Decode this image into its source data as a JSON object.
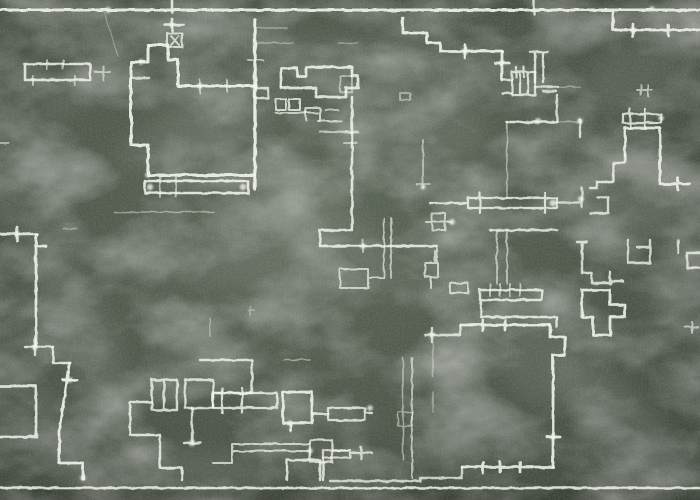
{
  "scene": {
    "subject": "hand-drawn chalk floor plan on a green chalkboard",
    "width": 700,
    "height": 500,
    "board": {
      "base_color_center": "#5a6455",
      "base_color_mid": "#4e574a",
      "base_color_edge": "#3f473c",
      "top_strip_color": "#3a4136",
      "bottom_strip_color": "#30362c"
    },
    "frame": {
      "color": "#e9eee3",
      "lines": [
        {
          "y": 10,
          "w": 3.0,
          "o": 0.95
        },
        {
          "y": 488,
          "w": 2.4,
          "o": 0.9
        }
      ]
    }
  },
  "drawing": {
    "chalk_color": "#f2f5ee",
    "strokes": [
      {
        "d": "M25,64 H90 V80 H25 Z",
        "w": 2.6,
        "o": 0.85
      },
      {
        "d": "M47,60 V69 M63,60 V69 M33,76 V85 M75,76 V85",
        "w": 2,
        "o": 0.6
      },
      {
        "d": "M95,72 H110 M103,66 V80",
        "w": 2,
        "o": 0.6
      },
      {
        "d": "M172,0 V12 M165,25 H184 M172,19 V31",
        "w": 2.6,
        "o": 0.85
      },
      {
        "d": "M167,33 H182 V47 H167 Z M171,36 L179,45 M179,36 L171,45",
        "w": 2,
        "o": 0.75
      },
      {
        "d": "M0,143 H9",
        "w": 2,
        "o": 0.5
      },
      {
        "d": "M104,12 L118,56",
        "w": 1.2,
        "o": 0.3
      },
      {
        "d": "M148,45 H168 V60 H178 V86 H255",
        "w": 3,
        "o": 0.9
      },
      {
        "d": "M148,45 V62 H131 V145 H148 V175 H255",
        "w": 3,
        "o": 0.9
      },
      {
        "d": "M131,78 H149",
        "w": 2.4,
        "o": 0.75
      },
      {
        "d": "M255,20 V189",
        "w": 3.4,
        "o": 0.92
      },
      {
        "d": "M200,80 V93 M227,80 V91 M248,60 H263",
        "w": 2,
        "o": 0.6
      },
      {
        "d": "M258,28 H287 M256,43 H293 M338,43 H358",
        "w": 1.4,
        "o": 0.38
      },
      {
        "d": "M145,181 H248 V193 H145 Z",
        "w": 2.6,
        "o": 0.88
      },
      {
        "d": "M160,177 V197 M176,177 V197",
        "w": 2,
        "o": 0.55
      },
      {
        "d": "M114,212 H214",
        "w": 1.6,
        "o": 0.45
      },
      {
        "d": "M64,229 H78",
        "w": 1.5,
        "o": 0.4
      },
      {
        "d": "M0,234 H37 M17,227 V241",
        "w": 2.6,
        "o": 0.85
      },
      {
        "d": "M36,234 V347 M38,246 H46",
        "w": 2.8,
        "o": 0.88
      },
      {
        "d": "M25,347 H53 M35,340 V355",
        "w": 2.4,
        "o": 0.8
      },
      {
        "d": "M53,347 V363 H70",
        "w": 2.4,
        "o": 0.85
      },
      {
        "d": "M70,363 L59,430 V463 H83 V479 M63,380 H77",
        "w": 2.8,
        "o": 0.9
      },
      {
        "d": "M0,386 H36 V437 H0",
        "w": 2.8,
        "o": 0.85
      },
      {
        "d": "M281,87 V68 H297 V76 H306 V67 H352 V76",
        "w": 2.8,
        "o": 0.88
      },
      {
        "d": "M352,76 H358 V88 H346 V97 H316 V88 H281",
        "w": 2.8,
        "o": 0.85
      },
      {
        "d": "M255,88 H268 V98 H255",
        "w": 2.4,
        "o": 0.8
      },
      {
        "d": "M276,99 H286 V110 H276 Z M289,99 H300 V110 H289 Z",
        "w": 2,
        "o": 0.78
      },
      {
        "d": "M276,113 H318 M318,121 H341",
        "w": 2,
        "o": 0.7
      },
      {
        "d": "M306,120 V108 H320 V121",
        "w": 2,
        "o": 0.72
      },
      {
        "d": "M320,132 H358 M325,110 H338",
        "w": 2,
        "o": 0.6
      },
      {
        "d": "M352,97 V230 H320 V246 H437",
        "w": 2.6,
        "o": 0.85
      },
      {
        "d": "M345,133 H359 M344,143 H357 M363,240 V252",
        "w": 2,
        "o": 0.55
      },
      {
        "d": "M437,246 V263 M425,263 H438 V277 H425 Z M435,251 V263 M431,277 V288",
        "w": 2,
        "o": 0.7
      },
      {
        "d": "M423,140 V188 M416,184 H430",
        "w": 1.8,
        "o": 0.55
      },
      {
        "d": "M384,218 V278 M391,218 V278",
        "w": 1.8,
        "o": 0.65
      },
      {
        "d": "M340,269 H368 V288 H340 Z M368,278 H384",
        "w": 2,
        "o": 0.7
      },
      {
        "d": "M450,283 H468 V293 H450 Z",
        "w": 2,
        "o": 0.7
      },
      {
        "d": "M403,18 V33 H427 V43 H440 V51 H502 M465,45 V58",
        "w": 2.8,
        "o": 0.9
      },
      {
        "d": "M502,51 V80 M495,63 H509",
        "w": 2.8,
        "o": 0.88
      },
      {
        "d": "M512,72 H535 V95 H512 Z M520,72 V95 M528,72 V95 M516,67 V77 M524,67 V77",
        "w": 2.2,
        "o": 0.8
      },
      {
        "d": "M502,80 H512 M502,93 H512",
        "w": 2.4,
        "o": 0.8
      },
      {
        "d": "M535,82 V52 H543 V82 M530,52 H548",
        "w": 2.4,
        "o": 0.82
      },
      {
        "d": "M535,87 H558 M543,91 H556",
        "w": 2.4,
        "o": 0.75
      },
      {
        "d": "M558,87 H580 M557,122 H580",
        "w": 1.5,
        "o": 0.42
      },
      {
        "d": "M557,95 V122 M580,120 V137",
        "w": 2.4,
        "o": 0.78
      },
      {
        "d": "M507,122 H557",
        "w": 2.6,
        "o": 0.85
      },
      {
        "d": "M507,122 V198",
        "w": 1.5,
        "o": 0.5
      },
      {
        "d": "M613,10 V30 H700 M633,24 V37 M668,25 V35",
        "w": 2.8,
        "o": 0.88
      },
      {
        "d": "M534,0 V14",
        "w": 2.4,
        "o": 0.8
      },
      {
        "d": "M637,90 H652 M641,85 V95 M648,85 V96",
        "w": 2,
        "o": 0.6
      },
      {
        "d": "M623,114 H661 V123 H623 Z M630,109 V128 M645,109 V128",
        "w": 2.2,
        "o": 0.8
      },
      {
        "d": "M625,155 V128 H660 V184 H690 M678,178 V190",
        "w": 2.8,
        "o": 0.88
      },
      {
        "d": "M625,155 V163 H613 V182 H597 V188 H590",
        "w": 2.4,
        "o": 0.82
      },
      {
        "d": "M597,197 H608 V213 H590",
        "w": 2.4,
        "o": 0.78
      },
      {
        "d": "M582,188 V207 M557,203 H581",
        "w": 2.6,
        "o": 0.7
      },
      {
        "d": "M582,242 V273 H592 V283 H611 M577,242 H587 M610,272 V284 M611,281 H623",
        "w": 2.4,
        "o": 0.8
      },
      {
        "d": "M628,240 V263 H650 V247 H637 M650,240 V247",
        "w": 2.4,
        "o": 0.78
      },
      {
        "d": "M678,240 V253 M687,253 H700 M687,253 V268 M687,268 H700",
        "w": 2.4,
        "o": 0.78
      },
      {
        "d": "M582,290 H610 V305 H625 V317 H610 V335 H593 V317 H582 Z",
        "w": 2.8,
        "o": 0.88
      },
      {
        "d": "M685,327 H698 M692,322 V333",
        "w": 2,
        "o": 0.6
      },
      {
        "d": "M460,325 H550 M483,320 V331 M505,320 V330",
        "w": 2.8,
        "o": 0.9
      },
      {
        "d": "M460,325 V335 H450 M425,335 H450 M432,328 V342",
        "w": 2.4,
        "o": 0.78
      },
      {
        "d": "M550,325 V337 H565 V355 H553 V467 M547,437 H560",
        "w": 2.8,
        "o": 0.9
      },
      {
        "d": "M462,467 H553 M483,462 V473 M500,462 V472 M520,462 V472",
        "w": 2.8,
        "o": 0.88
      },
      {
        "d": "M462,467 V478 H420 M330,481 H420 V478",
        "w": 2.4,
        "o": 0.75
      },
      {
        "d": "M412,358 V478",
        "w": 2,
        "o": 0.6
      },
      {
        "d": "M403,358 V460 M398,412 H412 V426 H398 Z",
        "w": 1.6,
        "o": 0.5
      },
      {
        "d": "M433,343 V377 M433,392 V412",
        "w": 1.4,
        "o": 0.4
      },
      {
        "d": "M480,290 H542 V300 H480 Z M481,300 V317 M481,317 H542 M542,317 H557 V327",
        "w": 2.4,
        "o": 0.84
      },
      {
        "d": "M490,284 V296 M500,284 V296 M510,284 V296 M520,284 V296",
        "w": 2,
        "o": 0.6
      },
      {
        "d": "M497,230 V284 M507,230 V284",
        "w": 1.8,
        "o": 0.6
      },
      {
        "d": "M490,230 H557",
        "w": 2.4,
        "o": 0.8
      },
      {
        "d": "M468,198 H557 V208 H468 Z M480,193 V213 M545,193 V213 M430,203 H468",
        "w": 2.2,
        "o": 0.82
      },
      {
        "d": "M432,213 H445 V230 H432 Z M426,222 H451",
        "w": 2,
        "o": 0.68
      },
      {
        "d": "M200,360 H252 V393 H213 V408",
        "w": 2.4,
        "o": 0.82
      },
      {
        "d": "M152,380 H177 V410 H152 Z M164,380 V410",
        "w": 2.4,
        "o": 0.8
      },
      {
        "d": "M185,380 H213 V408 H185 Z",
        "w": 2.4,
        "o": 0.8
      },
      {
        "d": "M152,402 H130 V435 H160 V468 H182 V480",
        "w": 2.4,
        "o": 0.84
      },
      {
        "d": "M192,408 V443 M184,443 H201",
        "w": 2.4,
        "o": 0.8
      },
      {
        "d": "M210,318 V336 M248,310 H254 M250,306 V315",
        "w": 1.5,
        "o": 0.4
      },
      {
        "d": "M284,360 H310",
        "w": 1.5,
        "o": 0.45
      },
      {
        "d": "M232,444 H310 M232,451 H310 M232,444 V463 M213,463 H232",
        "w": 2,
        "o": 0.72
      },
      {
        "d": "M310,440 H332 V462 H310 Z M332,450 H350",
        "w": 2.3,
        "o": 0.78
      },
      {
        "d": "M213,393 H277 V408 H213 M222,388 V413 M242,388 V413",
        "w": 2.3,
        "o": 0.82
      },
      {
        "d": "M283,392 H312 V423 H283 Z M291,423 V431",
        "w": 2.8,
        "o": 0.88
      },
      {
        "d": "M312,414 H328",
        "w": 3,
        "o": 0.78
      },
      {
        "d": "M328,408 H365 V420 H328 Z M365,413 H372",
        "w": 2.3,
        "o": 0.8
      },
      {
        "d": "M323,450 H350 V458 H323 Z M350,453 H372 M361,447 V459",
        "w": 2.3,
        "o": 0.76
      },
      {
        "d": "M287,480 V460 H320 V480 M323,458 V480",
        "w": 2.4,
        "o": 0.82
      },
      {
        "d": "M340,76 H352 V92 H340 Z",
        "w": 1.8,
        "o": 0.55
      },
      {
        "d": "M400,93 H410 V100 H400 Z",
        "w": 1.8,
        "o": 0.5
      }
    ],
    "nodes": [
      [
        108,
        10,
        3
      ],
      [
        652,
        9,
        2.6
      ],
      [
        172,
        25,
        2.6
      ],
      [
        465,
        51,
        3.2
      ],
      [
        502,
        63,
        3
      ],
      [
        553,
        203,
        3.4
      ],
      [
        581,
        199,
        3
      ],
      [
        192,
        443,
        3.2
      ],
      [
        70,
        380,
        2.8
      ],
      [
        35,
        347,
        3
      ],
      [
        17,
        234,
        2.8
      ],
      [
        370,
        408,
        2.8
      ],
      [
        432,
        335,
        3
      ],
      [
        553,
        437,
        2.8
      ],
      [
        661,
        118,
        2.8
      ],
      [
        633,
        30,
        2.8
      ],
      [
        150,
        187,
        3.2
      ],
      [
        243,
        187,
        3.2
      ],
      [
        141,
        62,
        2.8
      ],
      [
        200,
        86,
        2.8
      ],
      [
        538,
        121,
        3
      ],
      [
        580,
        121,
        2.8
      ],
      [
        290,
        423,
        2.6
      ],
      [
        452,
        222,
        3
      ],
      [
        310,
        451,
        2.8
      ],
      [
        83,
        478,
        2.8
      ],
      [
        363,
        246,
        2.6
      ],
      [
        423,
        187,
        2.4
      ],
      [
        255,
        87,
        3
      ],
      [
        148,
        175,
        2.8
      ]
    ],
    "smudges": [
      [
        80,
        330,
        90,
        28,
        65,
        0.1
      ],
      [
        60,
        440,
        80,
        24,
        55,
        0.09
      ],
      [
        230,
        260,
        110,
        30,
        8,
        0.08
      ],
      [
        200,
        130,
        90,
        26,
        -20,
        0.07
      ],
      [
        320,
        230,
        100,
        32,
        35,
        0.09
      ],
      [
        420,
        100,
        80,
        40,
        40,
        0.08
      ],
      [
        300,
        60,
        70,
        22,
        -10,
        0.06
      ],
      [
        630,
        190,
        70,
        45,
        10,
        0.1
      ],
      [
        640,
        70,
        60,
        35,
        -30,
        0.08
      ],
      [
        620,
        420,
        90,
        30,
        45,
        0.1
      ],
      [
        540,
        350,
        60,
        40,
        80,
        0.08
      ],
      [
        180,
        470,
        110,
        20,
        2,
        0.09
      ],
      [
        90,
        80,
        70,
        20,
        -35,
        0.07
      ],
      [
        480,
        440,
        80,
        22,
        5,
        0.06
      ],
      [
        680,
        300,
        50,
        30,
        60,
        0.07
      ],
      [
        205,
        105,
        55,
        4,
        -3,
        0.09
      ],
      [
        215,
        125,
        60,
        4,
        2,
        0.08
      ],
      [
        200,
        150,
        55,
        4,
        -2,
        0.08
      ],
      [
        500,
        305,
        14,
        9,
        0,
        0.22
      ],
      [
        350,
        420,
        30,
        8,
        10,
        0.12
      ]
    ]
  }
}
